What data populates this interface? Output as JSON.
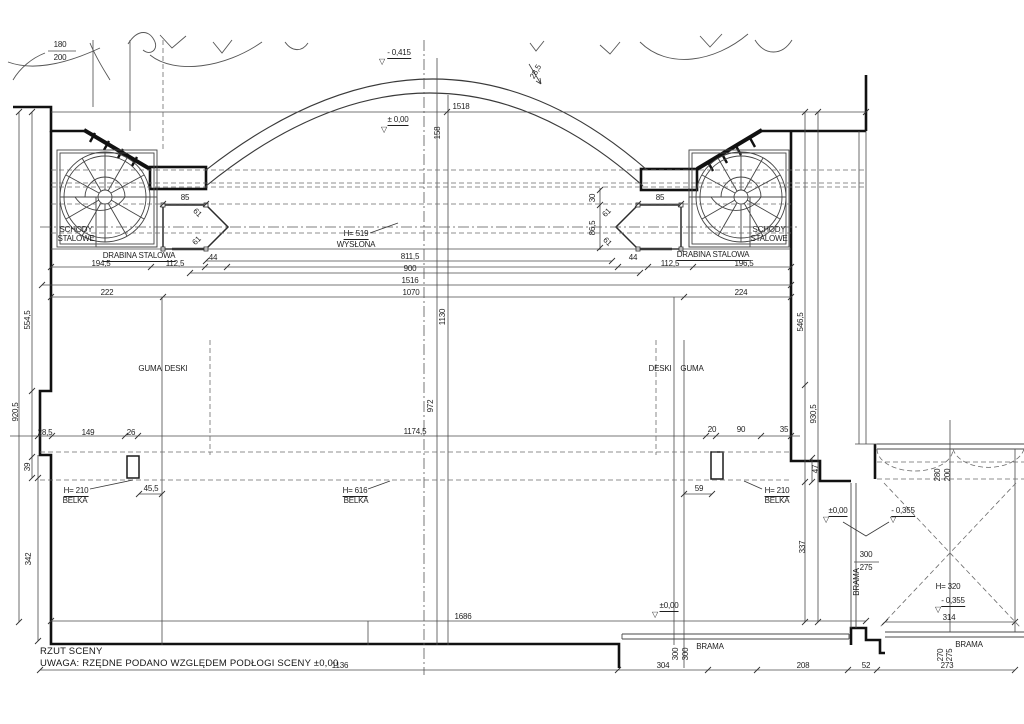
{
  "page": {
    "background": "#ffffff",
    "ink": "#1f1f1f",
    "width": 1024,
    "height": 724
  },
  "title_block": {
    "title": "RZUT SCENY",
    "note": "UWAGA: RZĘDNE PODANO WZGLĘDEM PODŁOGI SCENY ±0,00"
  },
  "legend_names": {
    "stairs": "SCHODY STALOWE",
    "ladder": "DRABINA STALOWA",
    "gate": "BRAMA",
    "beam": "BELKA",
    "curtain": "WYSŁONA",
    "rubber": "GUMA",
    "boards": "DESKI"
  },
  "elevations": [
    "±0,00",
    "- 0,415",
    "- 0,355"
  ],
  "annotations": [
    {
      "t": "180",
      "x": 60,
      "y": 45
    },
    {
      "t": "200",
      "x": 60,
      "y": 58
    },
    {
      "t": "- 0,415",
      "x": 399,
      "y": 54,
      "u": 1
    },
    {
      "t": "± 0,00",
      "x": 398,
      "y": 121,
      "u": 1
    },
    {
      "t": "1518",
      "x": 461,
      "y": 107
    },
    {
      "t": "158",
      "x": 438,
      "y": 133,
      "r": -90
    },
    {
      "t": "28,5",
      "x": 536,
      "y": 72,
      "r": -60
    },
    {
      "t": "H= 519",
      "x": 356,
      "y": 235,
      "u": 1
    },
    {
      "t": "WYSŁONA",
      "x": 356,
      "y": 245
    },
    {
      "t": "85",
      "x": 185,
      "y": 198
    },
    {
      "t": "85",
      "x": 660,
      "y": 198
    },
    {
      "t": "SCHODY",
      "x": 76,
      "y": 230
    },
    {
      "t": "STALOWE",
      "x": 76,
      "y": 239
    },
    {
      "t": "SCHODY",
      "x": 769,
      "y": 230
    },
    {
      "t": "STALOWE",
      "x": 769,
      "y": 239
    },
    {
      "t": "DRABINA STALOWA",
      "x": 139,
      "y": 257,
      "u": 1
    },
    {
      "t": "DRABINA STALOWA",
      "x": 713,
      "y": 256,
      "u": 1
    },
    {
      "t": "61",
      "x": 197,
      "y": 213,
      "r": 45
    },
    {
      "t": "61",
      "x": 197,
      "y": 241,
      "r": -45
    },
    {
      "t": "61",
      "x": 607,
      "y": 213,
      "r": -45
    },
    {
      "t": "61",
      "x": 607,
      "y": 242,
      "r": 45
    },
    {
      "t": "30",
      "x": 593,
      "y": 198,
      "r": -90
    },
    {
      "t": "86,5",
      "x": 593,
      "y": 228,
      "r": -90
    },
    {
      "t": "44",
      "x": 213,
      "y": 258
    },
    {
      "t": "44",
      "x": 633,
      "y": 258
    },
    {
      "t": "194,5",
      "x": 101,
      "y": 264
    },
    {
      "t": "112,5",
      "x": 175,
      "y": 264
    },
    {
      "t": "112,5",
      "x": 670,
      "y": 264
    },
    {
      "t": "196,5",
      "x": 744,
      "y": 264
    },
    {
      "t": "811,5",
      "x": 410,
      "y": 257
    },
    {
      "t": "900",
      "x": 410,
      "y": 269
    },
    {
      "t": "1516",
      "x": 410,
      "y": 281
    },
    {
      "t": "1070",
      "x": 411,
      "y": 293
    },
    {
      "t": "222",
      "x": 107,
      "y": 293
    },
    {
      "t": "224",
      "x": 741,
      "y": 293
    },
    {
      "t": "554,5",
      "x": 28,
      "y": 320,
      "r": -90
    },
    {
      "t": "920,5",
      "x": 16,
      "y": 412,
      "r": -90
    },
    {
      "t": "546,5",
      "x": 801,
      "y": 322,
      "r": -90
    },
    {
      "t": "930,5",
      "x": 814,
      "y": 414,
      "r": -90
    },
    {
      "t": "GUMA",
      "x": 150,
      "y": 369
    },
    {
      "t": "DESKI",
      "x": 176,
      "y": 369
    },
    {
      "t": "DESKI",
      "x": 660,
      "y": 369
    },
    {
      "t": "GUMA",
      "x": 692,
      "y": 369
    },
    {
      "t": "1130",
      "x": 443,
      "y": 317,
      "r": -90
    },
    {
      "t": "972",
      "x": 431,
      "y": 406,
      "r": -90
    },
    {
      "t": "28,5",
      "x": 45,
      "y": 433
    },
    {
      "t": "149",
      "x": 88,
      "y": 433
    },
    {
      "t": "26",
      "x": 131,
      "y": 433
    },
    {
      "t": "1174,5",
      "x": 415,
      "y": 432
    },
    {
      "t": "20",
      "x": 712,
      "y": 430
    },
    {
      "t": "90",
      "x": 741,
      "y": 430
    },
    {
      "t": "35",
      "x": 784,
      "y": 430
    },
    {
      "t": "39",
      "x": 28,
      "y": 467,
      "r": -90
    },
    {
      "t": "47",
      "x": 816,
      "y": 469,
      "r": -90
    },
    {
      "t": "45,5",
      "x": 151,
      "y": 489
    },
    {
      "t": "59",
      "x": 699,
      "y": 489
    },
    {
      "t": "H= 210",
      "x": 76,
      "y": 492,
      "u": 1
    },
    {
      "t": "BELKA",
      "x": 75,
      "y": 501
    },
    {
      "t": "H= 616",
      "x": 355,
      "y": 492,
      "u": 1
    },
    {
      "t": "BELKA",
      "x": 356,
      "y": 501
    },
    {
      "t": "H= 210",
      "x": 777,
      "y": 492,
      "u": 1
    },
    {
      "t": "BELKA",
      "x": 777,
      "y": 501
    },
    {
      "t": "342",
      "x": 29,
      "y": 559,
      "r": -90
    },
    {
      "t": "337",
      "x": 803,
      "y": 547,
      "r": -90
    },
    {
      "t": "1686",
      "x": 463,
      "y": 617
    },
    {
      "t": "±0,00",
      "x": 669,
      "y": 607,
      "u": 1
    },
    {
      "t": "±0,00",
      "x": 838,
      "y": 512,
      "u": 1
    },
    {
      "t": "- 0,355",
      "x": 903,
      "y": 512,
      "u": 1
    },
    {
      "t": "300",
      "x": 866,
      "y": 555
    },
    {
      "t": "275",
      "x": 866,
      "y": 568
    },
    {
      "t": "BRAMA",
      "x": 857,
      "y": 582,
      "r": -90
    },
    {
      "t": "H= 320",
      "x": 948,
      "y": 587
    },
    {
      "t": "- 0,355",
      "x": 953,
      "y": 602,
      "u": 1
    },
    {
      "t": "314",
      "x": 949,
      "y": 618
    },
    {
      "t": "280",
      "x": 938,
      "y": 475,
      "r": -90
    },
    {
      "t": "200",
      "x": 948,
      "y": 475,
      "r": -90
    },
    {
      "t": "300",
      "x": 676,
      "y": 654,
      "r": -90
    },
    {
      "t": "300",
      "x": 686,
      "y": 654,
      "r": -90
    },
    {
      "t": "BRAMA",
      "x": 710,
      "y": 647
    },
    {
      "t": "BRAMA",
      "x": 969,
      "y": 645
    },
    {
      "t": "270",
      "x": 941,
      "y": 655,
      "r": -90
    },
    {
      "t": "275",
      "x": 950,
      "y": 655,
      "r": -90
    },
    {
      "t": "304",
      "x": 663,
      "y": 666
    },
    {
      "t": "1136",
      "x": 340,
      "y": 666
    },
    {
      "t": "208",
      "x": 803,
      "y": 666
    },
    {
      "t": "52",
      "x": 866,
      "y": 666
    },
    {
      "t": "273",
      "x": 947,
      "y": 666
    },
    {
      "t": "▽",
      "x": 382,
      "y": 62,
      "k": "mark"
    },
    {
      "t": "▽",
      "x": 384,
      "y": 130,
      "k": "mark"
    },
    {
      "t": "▽",
      "x": 655,
      "y": 615,
      "k": "mark"
    },
    {
      "t": "▽",
      "x": 826,
      "y": 520,
      "k": "mark"
    },
    {
      "t": "▽",
      "x": 893,
      "y": 520,
      "k": "mark"
    },
    {
      "t": "▽",
      "x": 938,
      "y": 610,
      "k": "mark"
    }
  ]
}
